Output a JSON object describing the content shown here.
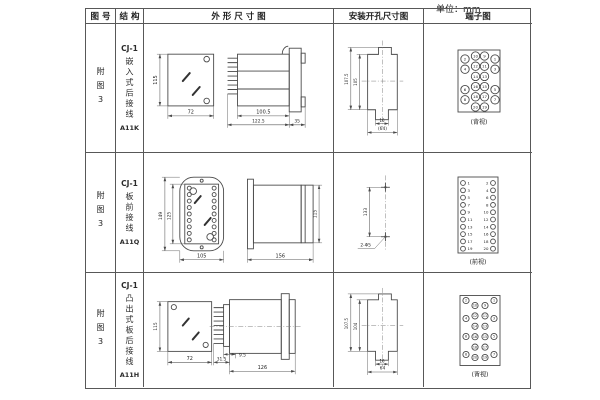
{
  "unit_label": "单位：mm",
  "headers": {
    "fig": "图 号",
    "struct": "结 构",
    "outline": "外 形 尺 寸 图",
    "mount": "安装开孔尺寸图",
    "terminal": "端子图"
  },
  "rows": [
    {
      "fig": "附图3",
      "struct_model": "CJ-1",
      "struct_name": "嵌入式后接线",
      "struct_code": "A11K",
      "outline": {
        "front_h": "115",
        "front_w": "72",
        "side_d1": "100.5",
        "side_d2": "122.5",
        "side_d3": "35"
      },
      "mount": {
        "d1": "107.5",
        "d2": "105",
        "d3": "16",
        "d4": "(64)"
      },
      "terminal": {
        "caption": "(背视)",
        "grid": [
          [
            "2",
            "10",
            "9",
            "1"
          ],
          [
            "4",
            "12",
            "11",
            "3"
          ],
          [
            "",
            "14",
            "13",
            ""
          ],
          [
            "6",
            "16",
            "15",
            "5"
          ],
          [
            "8",
            "18",
            "17",
            "7"
          ],
          [
            "",
            "20",
            "19",
            ""
          ]
        ]
      }
    },
    {
      "fig": "附图3",
      "struct_model": "CJ-1",
      "struct_name": "板前接线",
      "struct_code": "A11Q",
      "outline": {
        "front_h1": "149",
        "front_h2": "125",
        "front_w": "105",
        "side_w": "156",
        "side_h": "115"
      },
      "mount": {
        "d1": "133",
        "label": "2-Φ5"
      },
      "terminal": {
        "caption": "(前视)",
        "pairs": [
          [
            "1",
            "2"
          ],
          [
            "3",
            "4"
          ],
          [
            "5",
            "6"
          ],
          [
            "7",
            "8"
          ],
          [
            "9",
            "10"
          ],
          [
            "11",
            "12"
          ],
          [
            "13",
            "14"
          ],
          [
            "15",
            "16"
          ],
          [
            "17",
            "18"
          ],
          [
            "19",
            "20"
          ]
        ]
      }
    },
    {
      "fig": "附图3",
      "struct_model": "CJ-1",
      "struct_name": "凸出式板后接线",
      "struct_code": "A11H",
      "outline": {
        "front_h": "115",
        "front_w": "72",
        "side_d1": "31.5",
        "side_d2": "9.5",
        "side_d3": "126"
      },
      "mount": {
        "d1": "107.5",
        "d2": "104",
        "d3": "16",
        "d4": "64"
      },
      "terminal": {
        "caption": "(背视)",
        "stagger": {
          "left_outer": [
            "2",
            "4",
            "6",
            "8"
          ],
          "left_inner": [
            "10",
            "12",
            "14",
            "16",
            "18",
            "20"
          ],
          "right_inner": [
            "9",
            "11",
            "13",
            "15",
            "17",
            "19"
          ],
          "right_outer": [
            "1",
            "3",
            "5",
            "7"
          ]
        }
      }
    }
  ]
}
